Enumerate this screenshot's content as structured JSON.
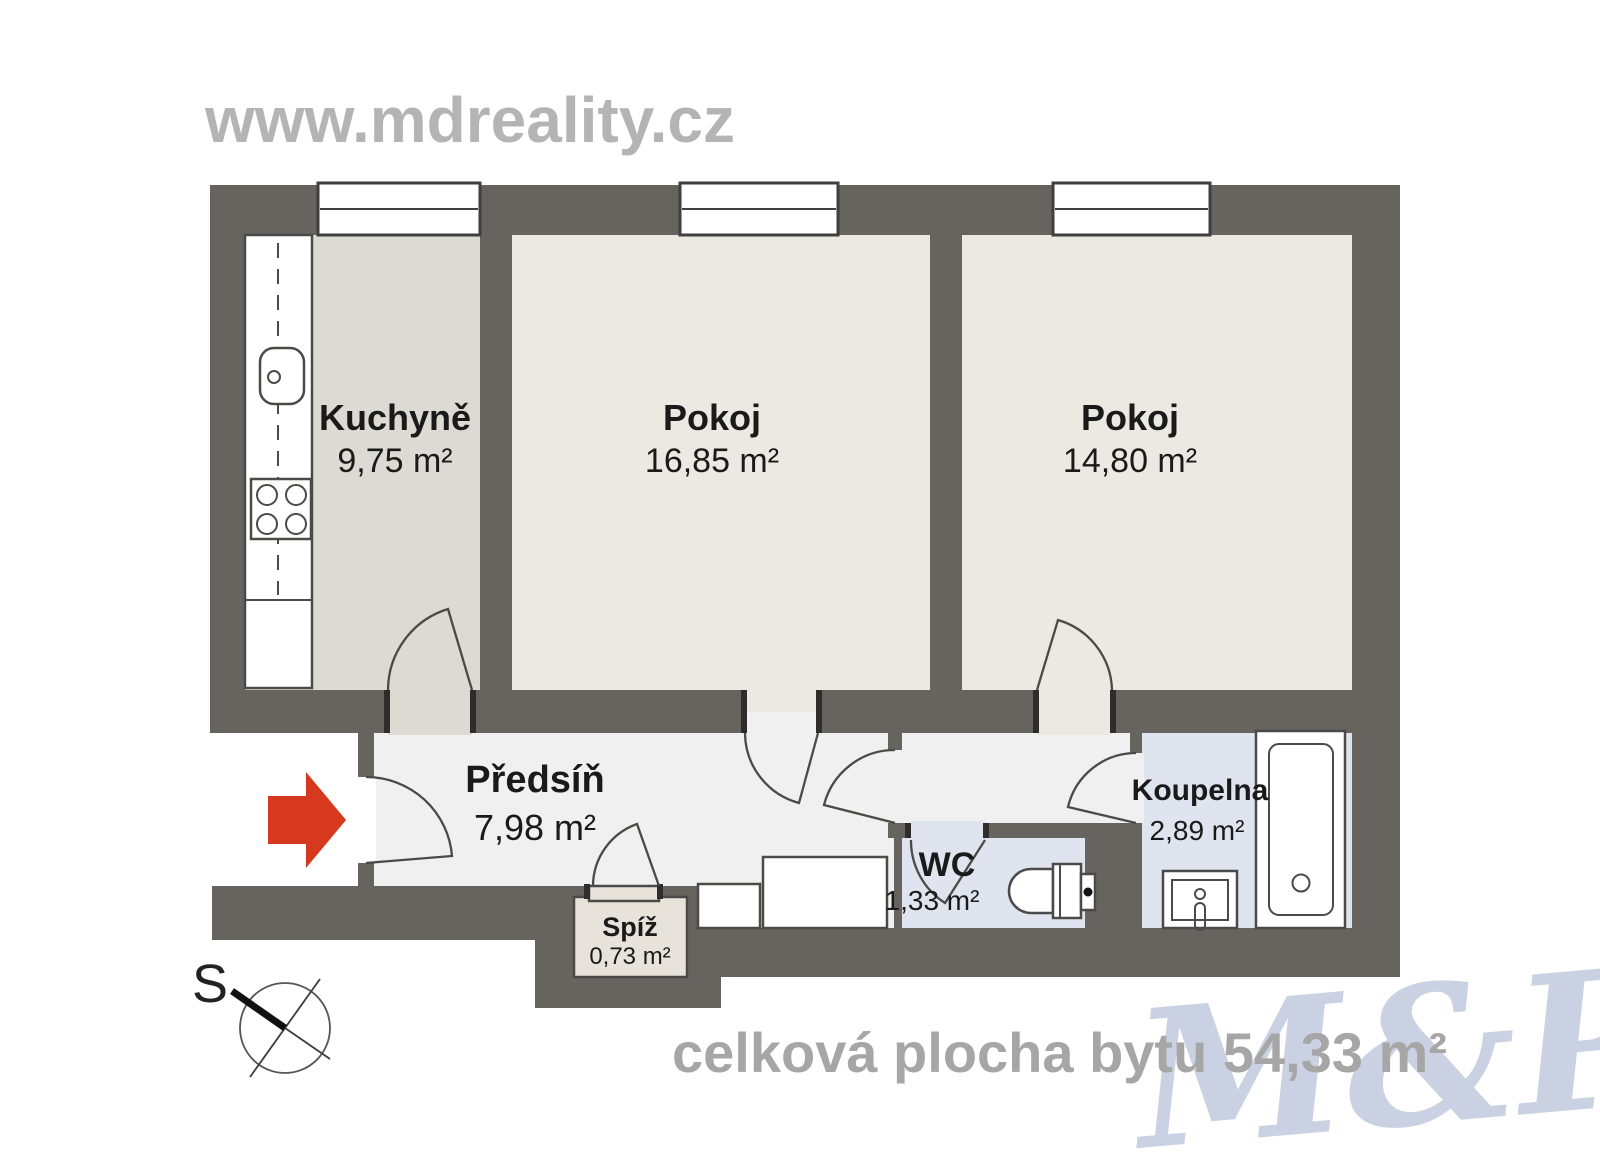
{
  "header": {
    "website": "www.mdreality.cz"
  },
  "plan": {
    "rooms": [
      {
        "name": "Kuchyně",
        "area": "9,75 m²"
      },
      {
        "name": "Pokoj",
        "area": "16,85 m²"
      },
      {
        "name": "Pokoj",
        "area": "14,80 m²"
      },
      {
        "name": "Předsíň",
        "area": "7,98 m²"
      },
      {
        "name": "Spíž",
        "area": "0,73 m²"
      },
      {
        "name": "WC",
        "area": "1,33 m²"
      },
      {
        "name": "Koupelna",
        "area": "2,89 m²"
      }
    ],
    "compass_label": "S"
  },
  "footer": {
    "total_label": "celková plocha bytu 54,33 m²"
  },
  "watermark": {
    "text": "M&P"
  },
  "colors": {
    "wall": "#67635f",
    "jamb": "#2e2d2b",
    "kitchen": "#dcdad3",
    "room": "#ece9e2",
    "hall": "#f0f0f0",
    "wet": "#dfe4ee",
    "pantry": "#e7e2da",
    "line": "#4a4a48",
    "frame": "#3f3f3f",
    "red": "#d6391e",
    "textGray": "#b4b4b4",
    "footGray": "#a6a6a6",
    "ink": "#1a1a1a",
    "watermark": "#c9d1e2"
  }
}
